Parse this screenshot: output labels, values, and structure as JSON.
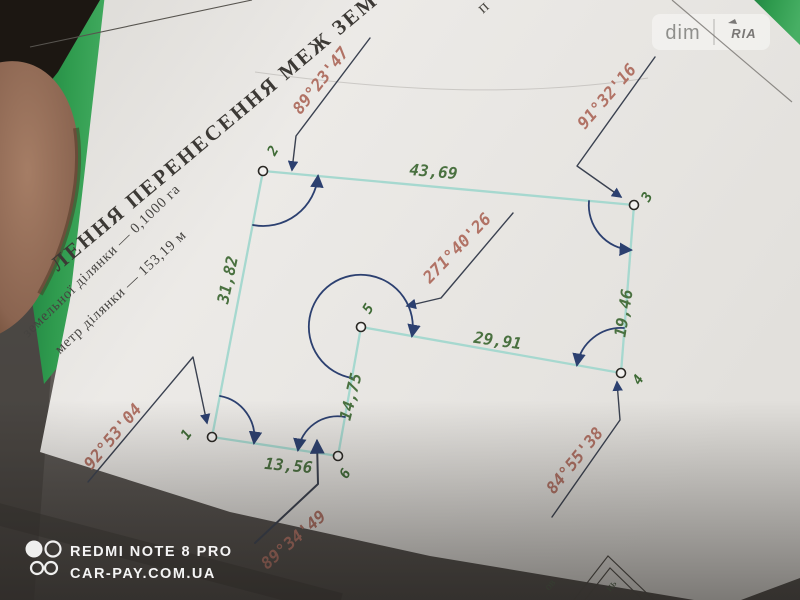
{
  "watermarks": {
    "site_badge": {
      "left": "dim",
      "right": "RIA"
    },
    "camera": {
      "device": "REDMI NOTE 8 PRO",
      "site": "CAR-PAY.COM.UA"
    }
  },
  "document": {
    "title_fragment": "ЛЕННЯ ПЕРЕНЕСЕННЯ МЕЖ ЗЕМ",
    "top_edge_fragment": "п",
    "area_line": "земельної ділянки — 0,1000 га",
    "perimeter_line": "метр ділянки — 153,19 м",
    "corner_fragment_1": "ов",
    "corner_fragment_2": "нь"
  },
  "survey": {
    "area": "0,1000 га",
    "perimeter": "153,19 м",
    "points": [
      {
        "id": "1",
        "angle": "92°53'04"
      },
      {
        "id": "2",
        "angle": "89°23'47"
      },
      {
        "id": "3",
        "angle": "91°32'16"
      },
      {
        "id": "4",
        "angle": "84°55'38"
      },
      {
        "id": "5",
        "angle": "271°40'26"
      },
      {
        "id": "6",
        "angle": "89°34'49"
      }
    ],
    "sides": [
      {
        "from": "2",
        "to": "3",
        "length": "43,69"
      },
      {
        "from": "1",
        "to": "2",
        "length": "31,82"
      },
      {
        "from": "3",
        "to": "4",
        "length": "19,46"
      },
      {
        "from": "5",
        "to": "4",
        "length": "29,91"
      },
      {
        "from": "5",
        "to": "6",
        "length": "14,75"
      },
      {
        "from": "6",
        "to": "1",
        "length": "13,56"
      }
    ]
  },
  "colors": {
    "boundary_line": "#a6d8cf",
    "annotation_blue": "#2c4070",
    "length_text_green": "#4a7140",
    "angle_text_red": "#b17265",
    "folder_green": "#2f9b4e",
    "paper": "#e9e7e4"
  }
}
